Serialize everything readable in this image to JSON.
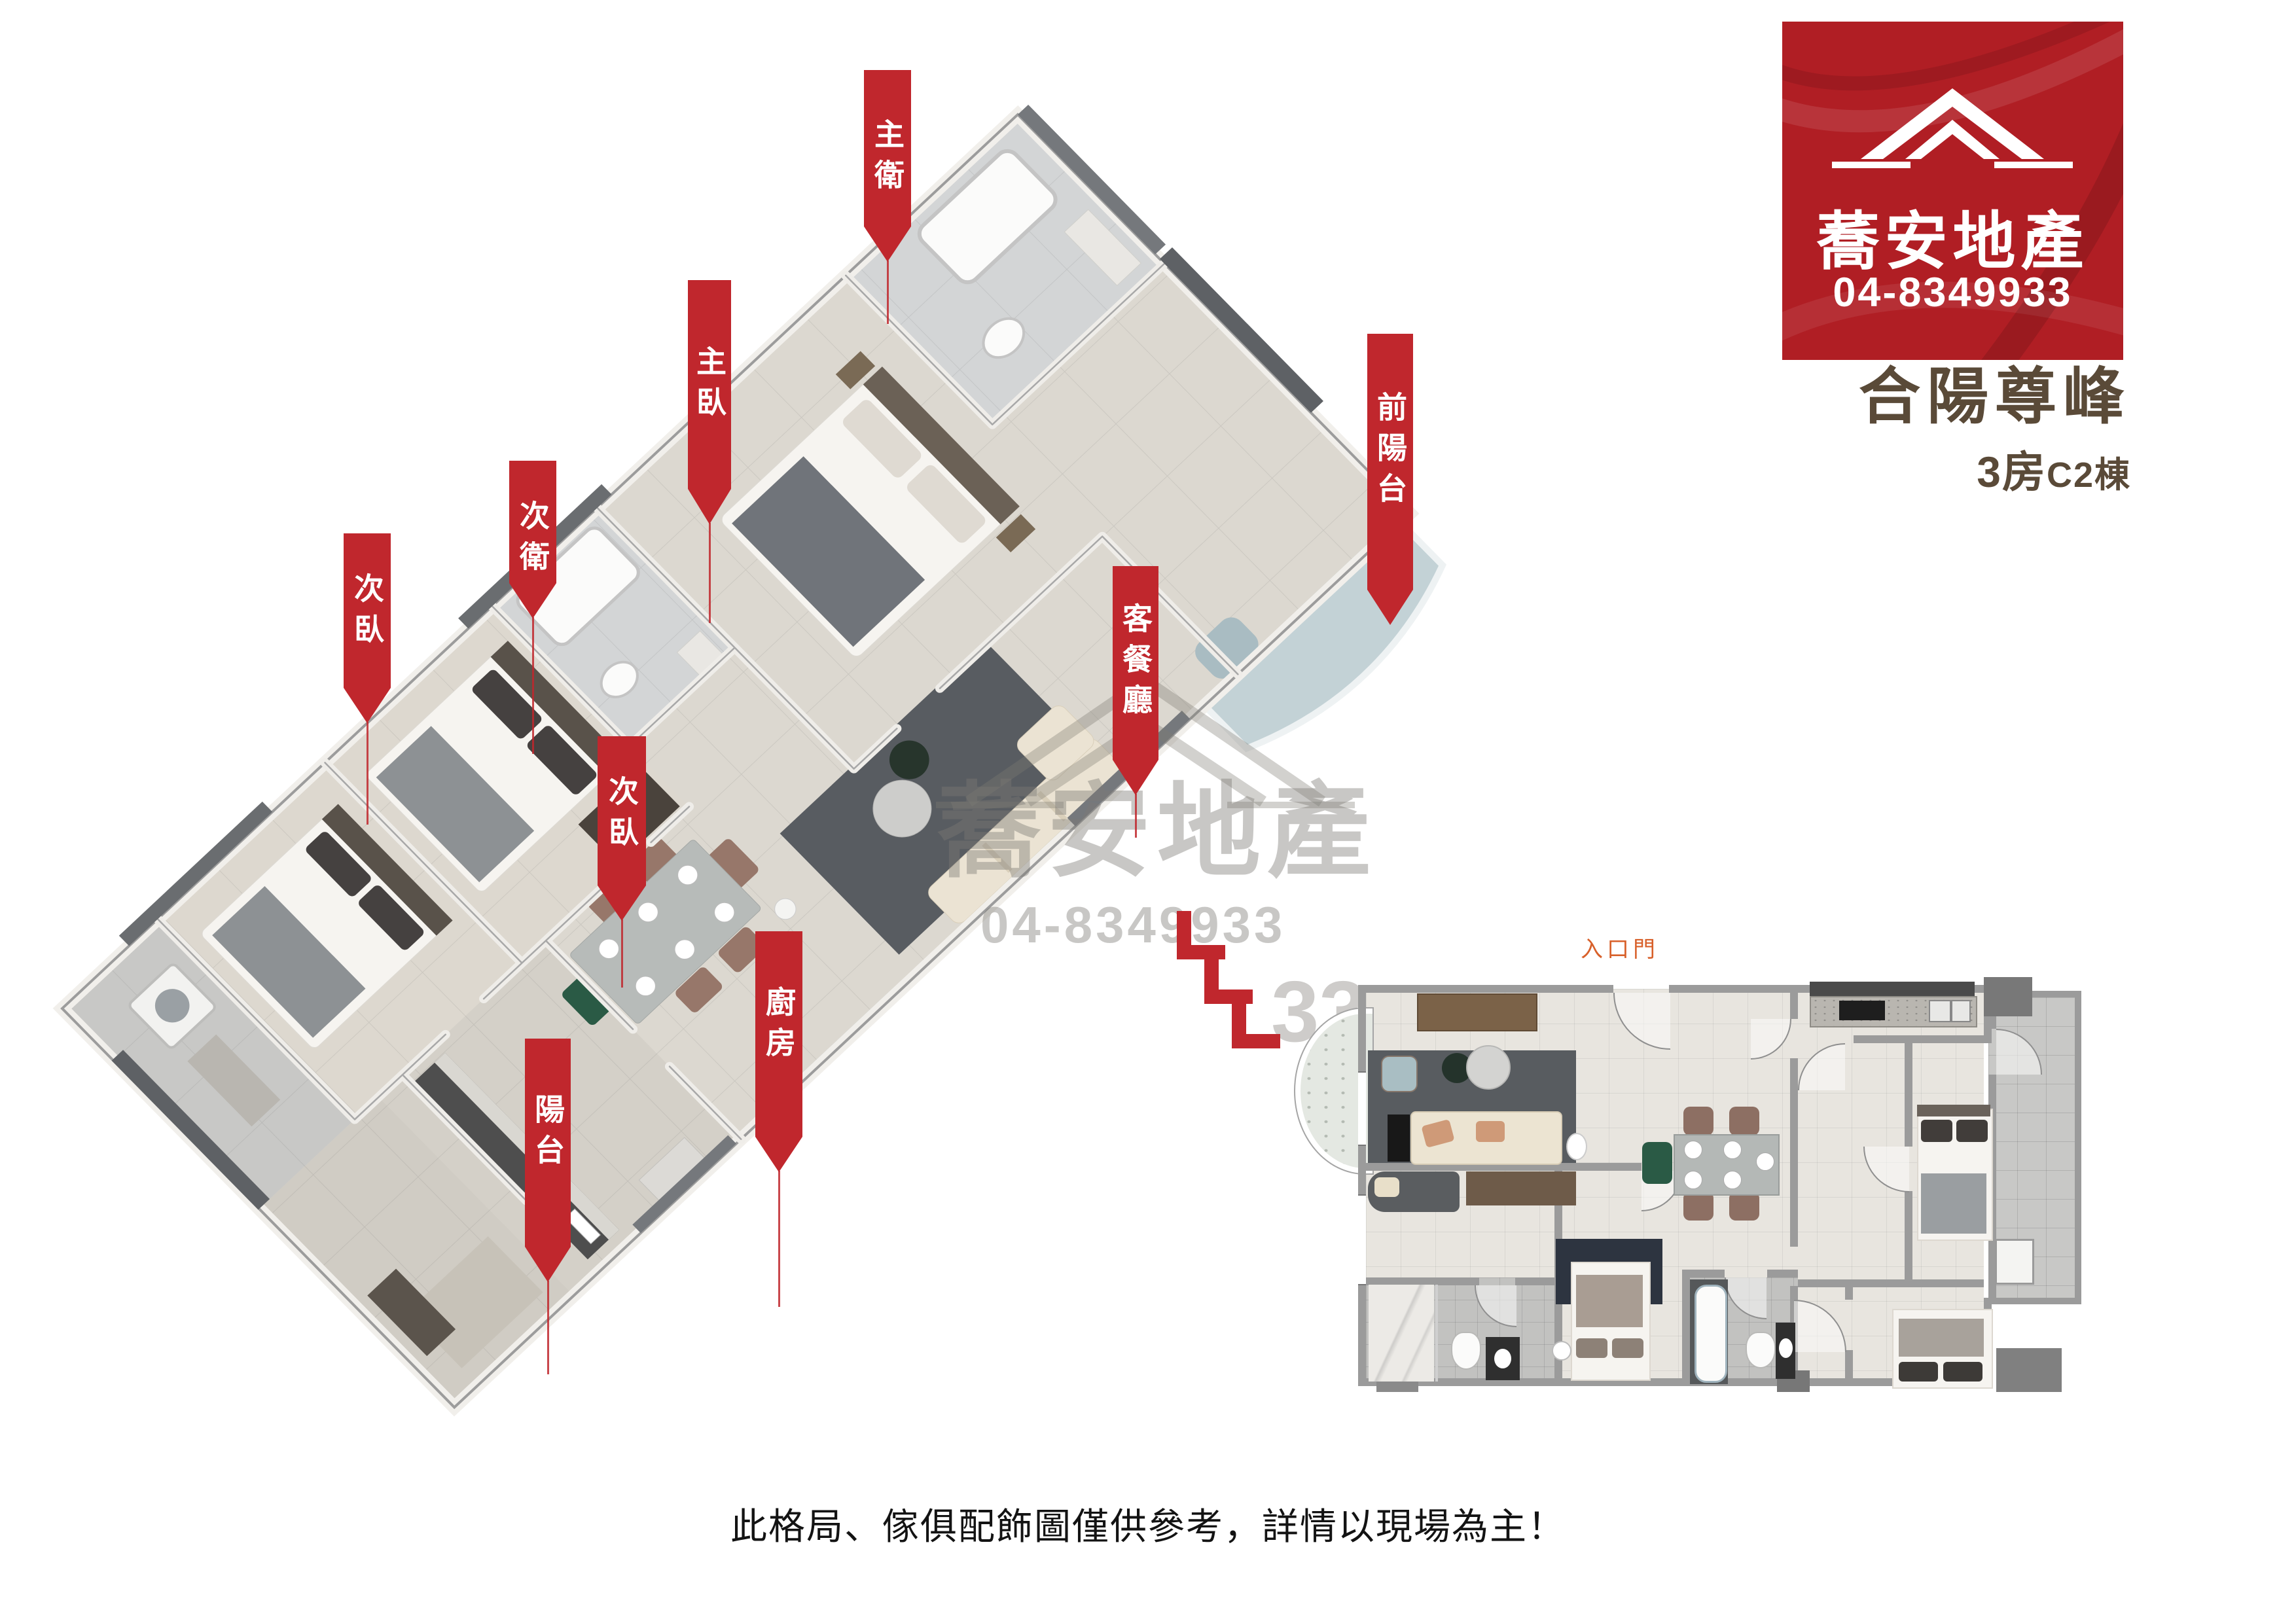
{
  "logo": {
    "brand": "蕎安地產",
    "phone": "04-8349933"
  },
  "title": {
    "name": "合陽尊峰",
    "spec_main": "3房",
    "spec_sub": "C2棟"
  },
  "flags": [
    {
      "id": "master-bath",
      "text": "主衛"
    },
    {
      "id": "master-bedroom",
      "text": "主臥"
    },
    {
      "id": "second-bath",
      "text": "次衛"
    },
    {
      "id": "second-bedroom-left",
      "text": "次臥"
    },
    {
      "id": "second-bedroom-mid",
      "text": "次臥"
    },
    {
      "id": "living-dining",
      "text": "客餐廳"
    },
    {
      "id": "kitchen",
      "text": "廚房"
    },
    {
      "id": "rear-balcony",
      "text": "陽台"
    },
    {
      "id": "front-balcony",
      "text": "前陽台"
    }
  ],
  "floorplan2d": {
    "entry_label": "入口門"
  },
  "watermark": {
    "brand": "蕎安地產",
    "phone": "04-8349933",
    "partial": "33"
  },
  "disclaimer": "此格局、傢俱配飾圖僅供參考，詳情以現場為主！",
  "colors": {
    "flag_red": "#c0272d",
    "logo_red": "#b01e24",
    "title_text": "#5a4a38",
    "entry_orange": "#d8602a"
  }
}
